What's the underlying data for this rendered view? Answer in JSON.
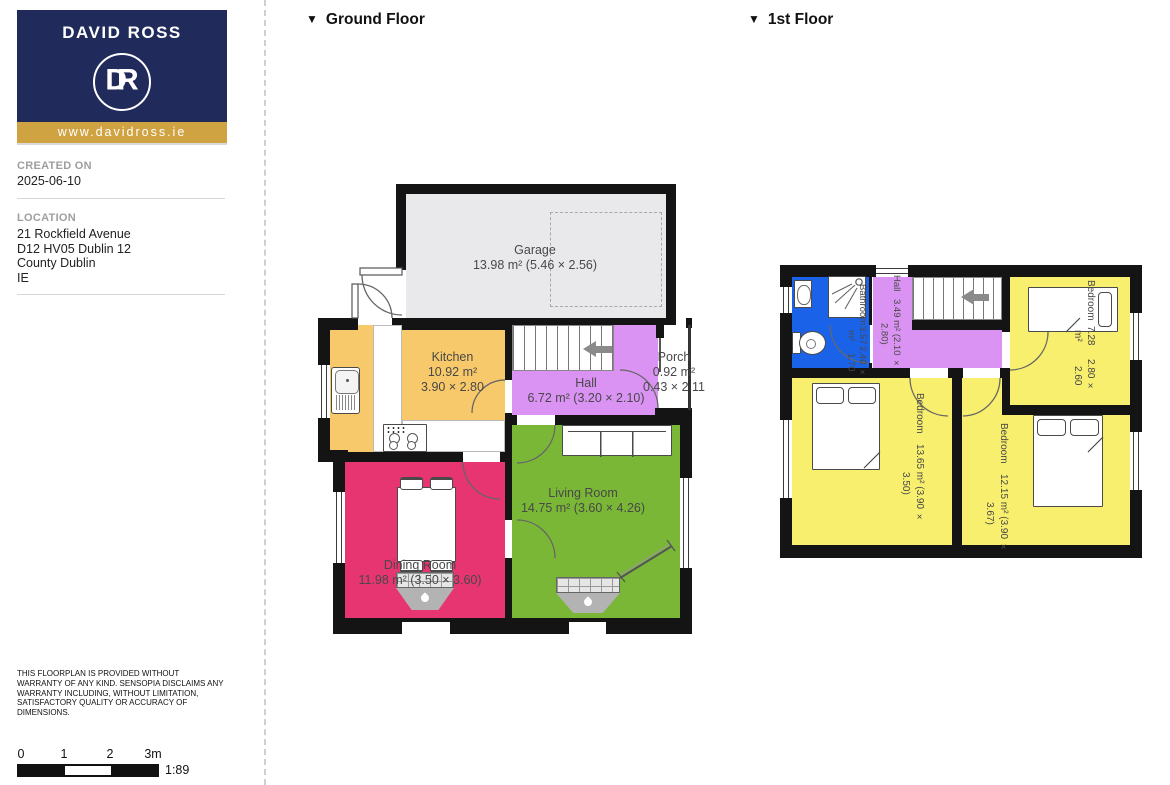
{
  "branding": {
    "name": "DAVID ROSS",
    "monogram": "DR",
    "url": "www.davidross.ie",
    "navy": "#202b5c",
    "gold": "#d0a342"
  },
  "meta": {
    "created_label": "CREATED ON",
    "created_value": "2025-06-10",
    "location_label": "LOCATION",
    "address_lines": [
      "21 Rockfield Avenue",
      "D12 HV05 Dublin 12",
      "County Dublin",
      "IE"
    ]
  },
  "disclaimer": "THIS FLOORPLAN IS PROVIDED WITHOUT WARRANTY OF ANY KIND. SENSOPIA DISCLAIMS ANY WARRANTY INCLUDING, WITHOUT LIMITATION, SATISFACTORY QUALITY OR ACCURACY OF DIMENSIONS.",
  "scale": {
    "ticks": [
      "0",
      "1",
      "2",
      "3m"
    ],
    "ratio": "1:89"
  },
  "floors": {
    "ground": {
      "marker": "▼",
      "header": "Ground Floor"
    },
    "first": {
      "marker": "▼",
      "header": "1st Floor"
    }
  },
  "ground_floor": {
    "garage": {
      "name": "Garage",
      "area": "13.98 m² (5.46 × 2.56)"
    },
    "kitchen": {
      "name": "Kitchen",
      "line2": "10.92 m²",
      "line3": "3.90 × 2.80"
    },
    "hall": {
      "name": "Hall",
      "area": "6.72 m² (3.20 × 2.10)"
    },
    "porch": {
      "name": "Porch",
      "line2": "0.92 m²",
      "line3": "0.43 × 2.11"
    },
    "living": {
      "name": "Living Room",
      "area": "14.75 m² (3.60 × 4.26)"
    },
    "dining": {
      "name": "Dining Room",
      "area": "11.98 m² (3.50 × 3.60)"
    }
  },
  "first_floor": {
    "hall": {
      "name": "Hall",
      "area": "3.49 m² (2.10 × 2.80)"
    },
    "bathroom": {
      "name": "Bathroom",
      "line2": "3.57 m²",
      "line3": "2.40 × 1.70"
    },
    "bedroom_small": {
      "name": "Bedroom",
      "line2": "7.28 m²",
      "line3": "2.80 × 2.60"
    },
    "bedroom_left": {
      "name": "Bedroom",
      "area": "13.65 m² (3.90 × 3.50)"
    },
    "bedroom_right": {
      "name": "Bedroom",
      "area": "12.15 m² (3.90 × 3.67)"
    }
  },
  "colors": {
    "wall": "#141414",
    "garage": "#e9e9ec",
    "kitchen": "#f8c96a",
    "hall": "#da93f2",
    "dining": "#e73571",
    "living": "#7ab737",
    "bedroom": "#f8ef6e",
    "bathroom": "#1a63e9"
  }
}
